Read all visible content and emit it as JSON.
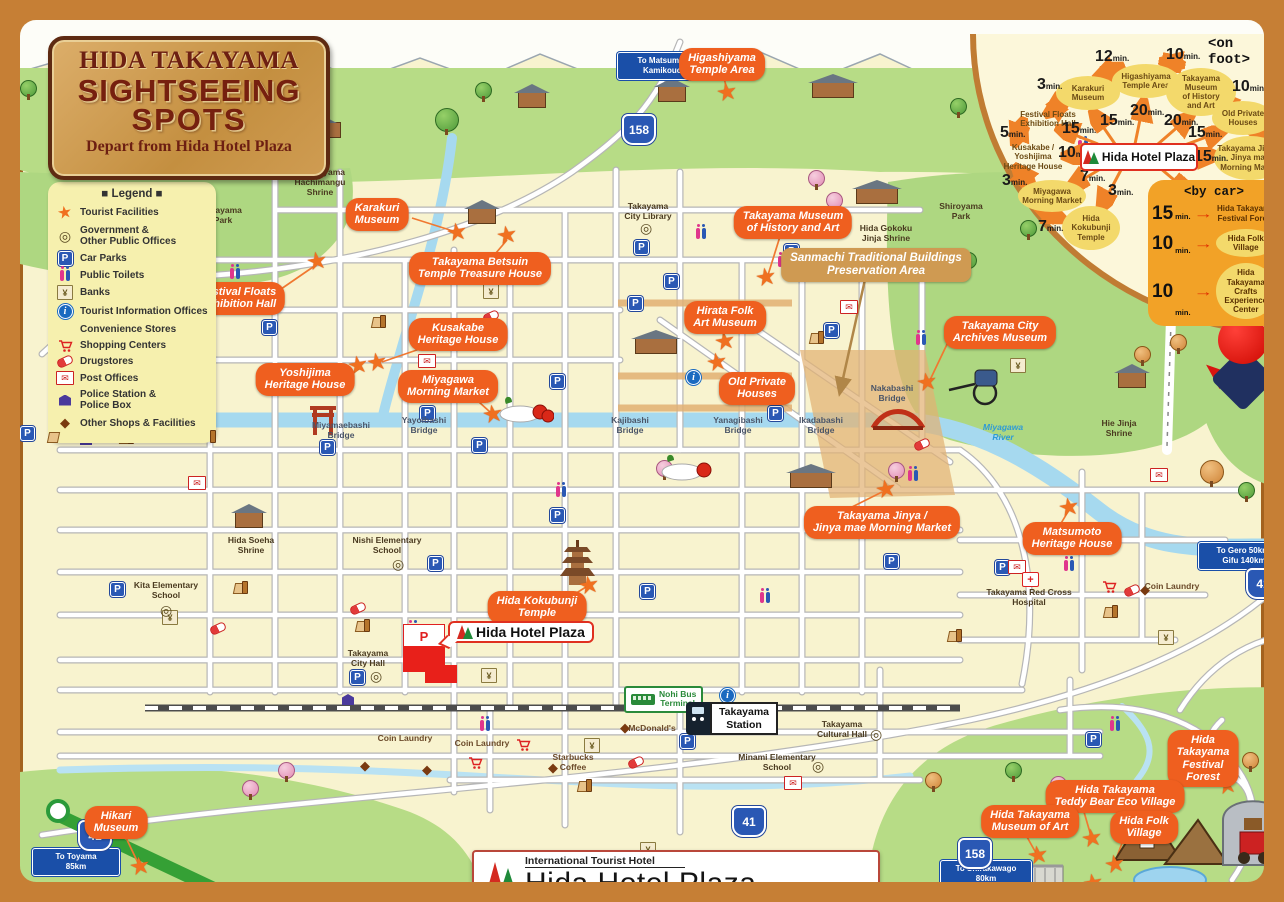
{
  "title_sign": {
    "line1": "HIDA TAKAYAMA",
    "line2": "SIGHTSEEING",
    "line3": "SPOTS",
    "subtitle": "Depart from Hida Hotel Plaza"
  },
  "legend": {
    "heading": "■ Legend ■",
    "items": [
      "Tourist Facilities",
      "Government &\nOther Public Offices",
      "Car Parks",
      "Public Toilets",
      "Banks",
      "Tourist Information Offices",
      "Convenience Stores",
      "Shopping Centers",
      "Drugstores",
      "Post Offices",
      "Police Station &\nPolice Box",
      "Other Shops & Facilities"
    ]
  },
  "icons": {
    "star": "★",
    "parking": "P",
    "bank_yen": "¥",
    "info": "i",
    "post_envelope": "✉",
    "other_diamond": "◆",
    "gov_circle": "◎",
    "hospital_cross": "+",
    "arrow_right": "→"
  },
  "on_foot": {
    "heading": "<on foot>",
    "hub": "Hida Hotel Plaza",
    "nodes": [
      "Karakuri\nMuseum",
      "Higashiyama\nTemple Area",
      "Takayama\nMuseum\nof History\nand Art",
      "Old Private\nHouses",
      "Takayama Jinya /\nJinya mae\nMorning Market",
      "Kusakabe /\nYoshijima\nHeritage House",
      "Festival Floats\nExhibition Hall",
      "Miyagawa\nMorning Market",
      "Hida\nKokubunji\nTemple"
    ],
    "times": [
      {
        "n": "3",
        "u": "min."
      },
      {
        "n": "12",
        "u": "min."
      },
      {
        "n": "10",
        "u": "min."
      },
      {
        "n": "10",
        "u": "min."
      },
      {
        "n": "3",
        "u": "min."
      },
      {
        "n": "5",
        "u": "min."
      },
      {
        "n": "15",
        "u": "min."
      },
      {
        "n": "15",
        "u": "min."
      },
      {
        "n": "20",
        "u": "min."
      },
      {
        "n": "20",
        "u": "min."
      },
      {
        "n": "15",
        "u": "min."
      },
      {
        "n": "15",
        "u": "min."
      },
      {
        "n": "10",
        "u": "min."
      },
      {
        "n": "7",
        "u": "min."
      },
      {
        "n": "3",
        "u": "min."
      },
      {
        "n": "3",
        "u": "min."
      },
      {
        "n": "7",
        "u": "min."
      }
    ]
  },
  "by_car": {
    "heading": "<by car>",
    "items": [
      {
        "num": "15",
        "unit": "min.",
        "name": "Hida Takayama\nFestival Forest"
      },
      {
        "num": "10",
        "unit": "min.",
        "name": "Hida Folk\nVillage"
      },
      {
        "num": "10",
        "unit": "min.",
        "name": "Hida Takayama\nCrafts Experience\nCenter"
      }
    ]
  },
  "spot_labels": [
    "Higashiyama\nTemple Area",
    "Karakuri\nMuseum",
    "Takayama Betsuin\nTemple Treasure House",
    "Festival Floats\nExhibition Hall",
    "Kusakabe\nHeritage House",
    "Yoshijima\nHeritage House",
    "Miyagawa\nMorning Market",
    "Takayama Museum\nof History and Art",
    "Hirata Folk\nArt Museum",
    "Old Private\nHouses",
    "Takayama City\nArchives Museum",
    "Takayama Jinya /\nJinya mae Morning Market",
    "Matsumoto\nHeritage House",
    "Hida Kokubunji\nTemple",
    "Hikari\nMuseum",
    "Hida Takayama\nFestival Forest",
    "Hida Takayama\nTeddy Bear Eco Village",
    "Hida Takayama\nMuseum of Art",
    "Hida Folk\nVillage",
    "Hida Takayama\nCrafts Experience Center",
    "Sanmachi Traditional Buildings\nPreservation Area"
  ],
  "small_labels": [
    "Sakurayama\nHachimangu\nShrine",
    "Kitayama\nPark",
    "Takayama\nCity Library",
    "Hida Gokoku\nJinja Shrine",
    "Shiroyama\nPark",
    "Miyamaebashi\nBridge",
    "Yayoibashi\nBridge",
    "Kajibashi\nBridge",
    "Yanagibashi\nBridge",
    "Ikadabashi\nBridge",
    "Nakabashi\nBridge",
    "Hie Jinja\nShrine",
    "Hida Soeha\nShrine",
    "Nishi Elementary\nSchool",
    "Kita Elementary\nSchool",
    "Takayama\nCity Hall",
    "Takayama Red Cross\nHospital",
    "Coin Laundry",
    "Coin Laundry",
    "Coin Laundry",
    "McDonald's",
    "Starbucks\nCoffee",
    "Takayama\nCultural Hall",
    "Minami Elementary\nSchool",
    "Miyagawa\nRiver"
  ],
  "road_signs": {
    "matsumoto": "To Matsumoto 95km,\nKamikouchi 58km",
    "toyama": "To Toyama\n85km",
    "gero": "To Gero 50km,\nGifu 140km",
    "shirakawago": "To Shirakawago\n80km",
    "route158": "158",
    "route41": "41"
  },
  "transit": {
    "station": "Takayama\nStation",
    "bus_terminal": "Nohi Bus\nTerminal"
  },
  "hotel": {
    "map_label": "Hida Hotel Plaza"
  },
  "footer": {
    "tagline": "International Tourist Hotel",
    "name": "Hida Hotel Plaza",
    "address": "2-60 HANAOKA-CHO,TAKAYAMA CITY,GIFU PREF,506-0009",
    "phone": "PHONE 0577-33-4600"
  }
}
